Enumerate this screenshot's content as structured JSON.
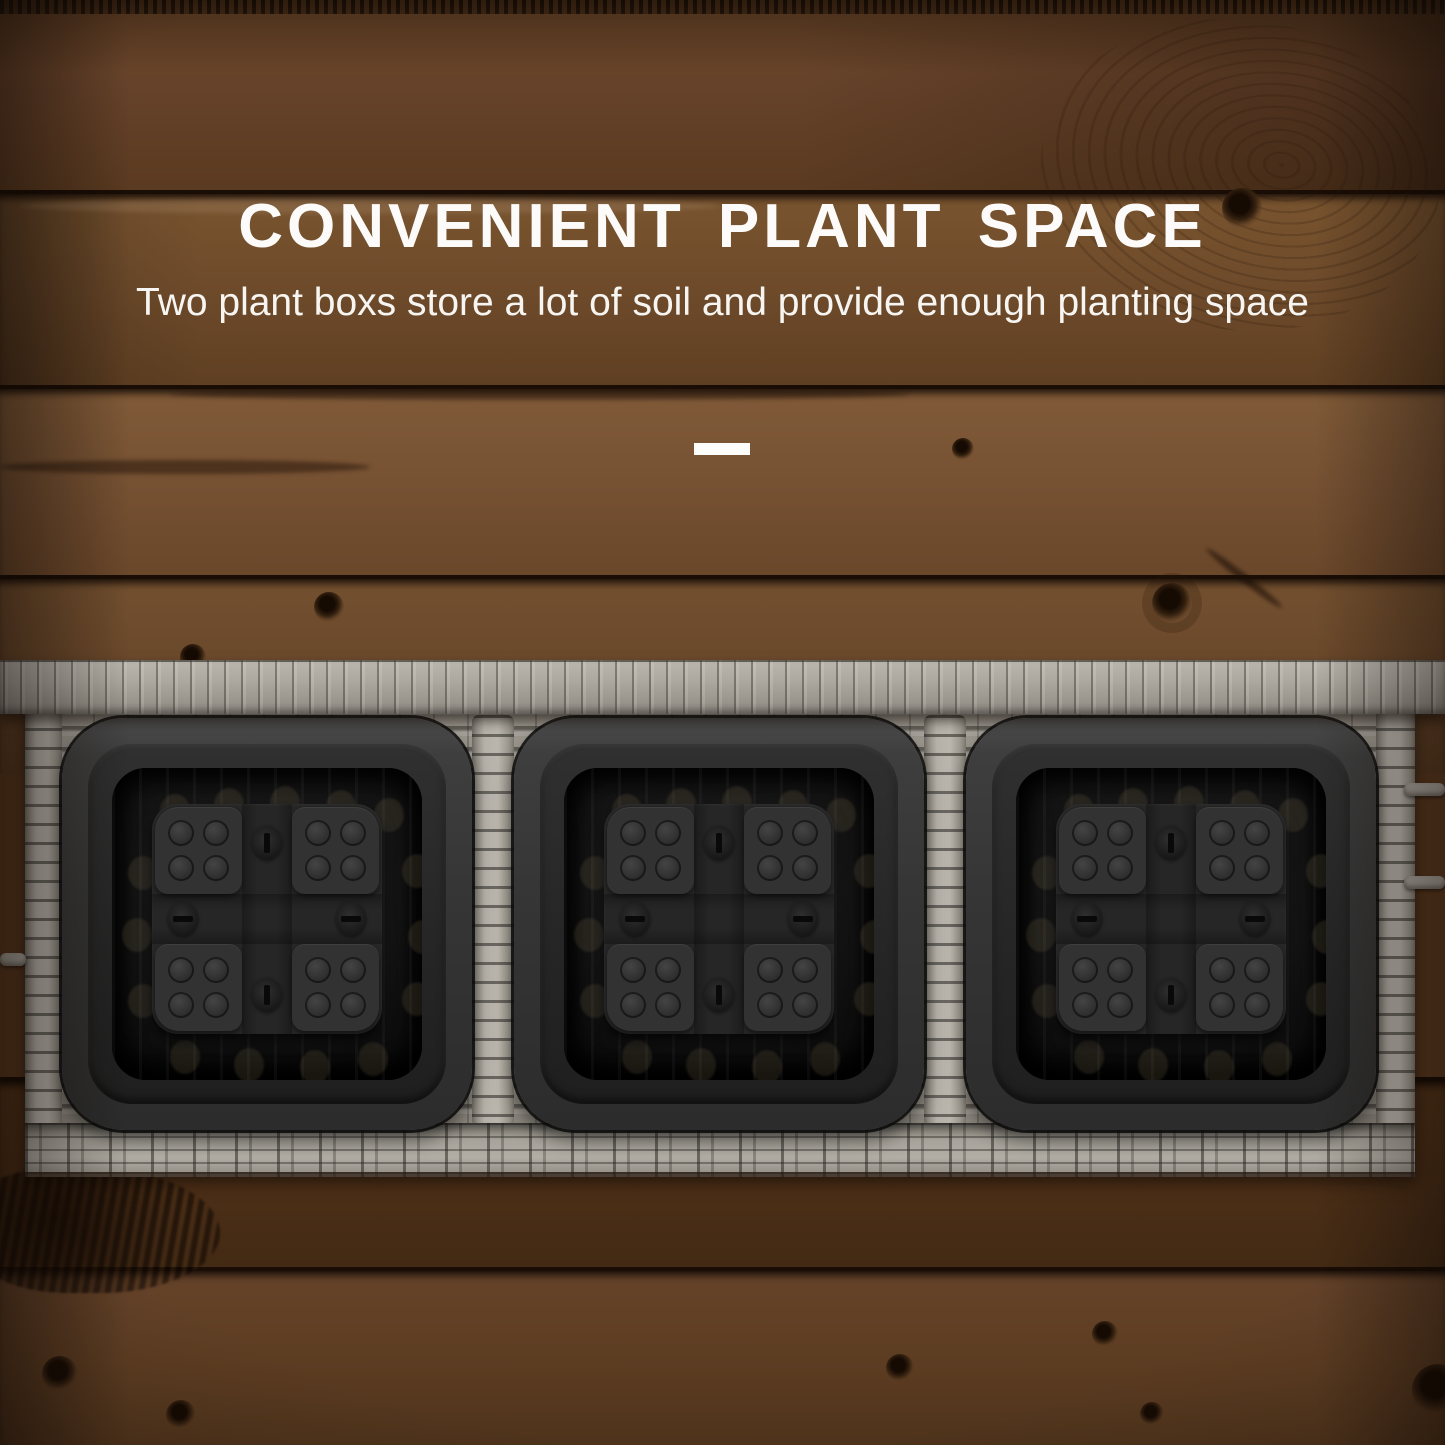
{
  "page": {
    "type": "product-feature-image"
  },
  "hero": {
    "title": "CONVENIENT PLANT SPACE",
    "subtitle": "Two plant boxs store a lot of soil and provide enough planting space"
  },
  "colors": {
    "text": "#ffffff",
    "wood_mid": "#6f4b2c",
    "wood_dark": "#4e3119",
    "wicker_gray": "#aaa69d",
    "box_black": "#262626"
  },
  "planter": {
    "box_count": 3,
    "pads_per_box": 4,
    "dots_per_pad": 4,
    "screws_per_box": 4
  }
}
